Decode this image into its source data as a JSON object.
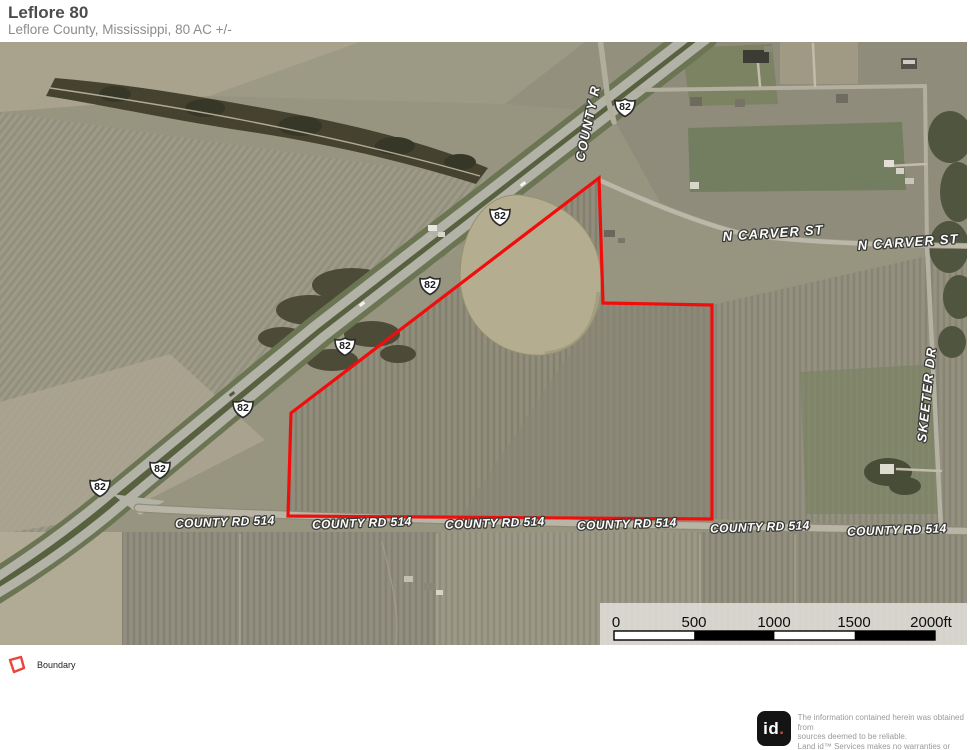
{
  "header": {
    "title": "Leflore 80",
    "subtitle": "Leflore County, Mississippi, 80 AC +/-"
  },
  "map": {
    "highway_shield_label": "82",
    "road_labels": {
      "county_r": "COUNTY R",
      "n_carver_st": "N CARVER ST",
      "skeeter_dr": "SKEETER DR",
      "county_rd_514": "COUNTY RD 514"
    },
    "scale_bar": {
      "labels": [
        "0",
        "500",
        "1000",
        "1500",
        "2000ft"
      ]
    }
  },
  "colors": {
    "boundary": "#f20d0d",
    "legend_icon": "#e8463c",
    "logo_dot": "#e23d35"
  },
  "legend": {
    "boundary_label": "Boundary"
  },
  "footer": {
    "logo_text": "id",
    "logo_dot": ".",
    "disclaimer_lines": [
      "The information contained herein was obtained from",
      "sources deemed to be reliable.",
      " Land id™ Services makes no warranties or guarantees",
      "as to the completeness or accuracy thereof."
    ]
  }
}
